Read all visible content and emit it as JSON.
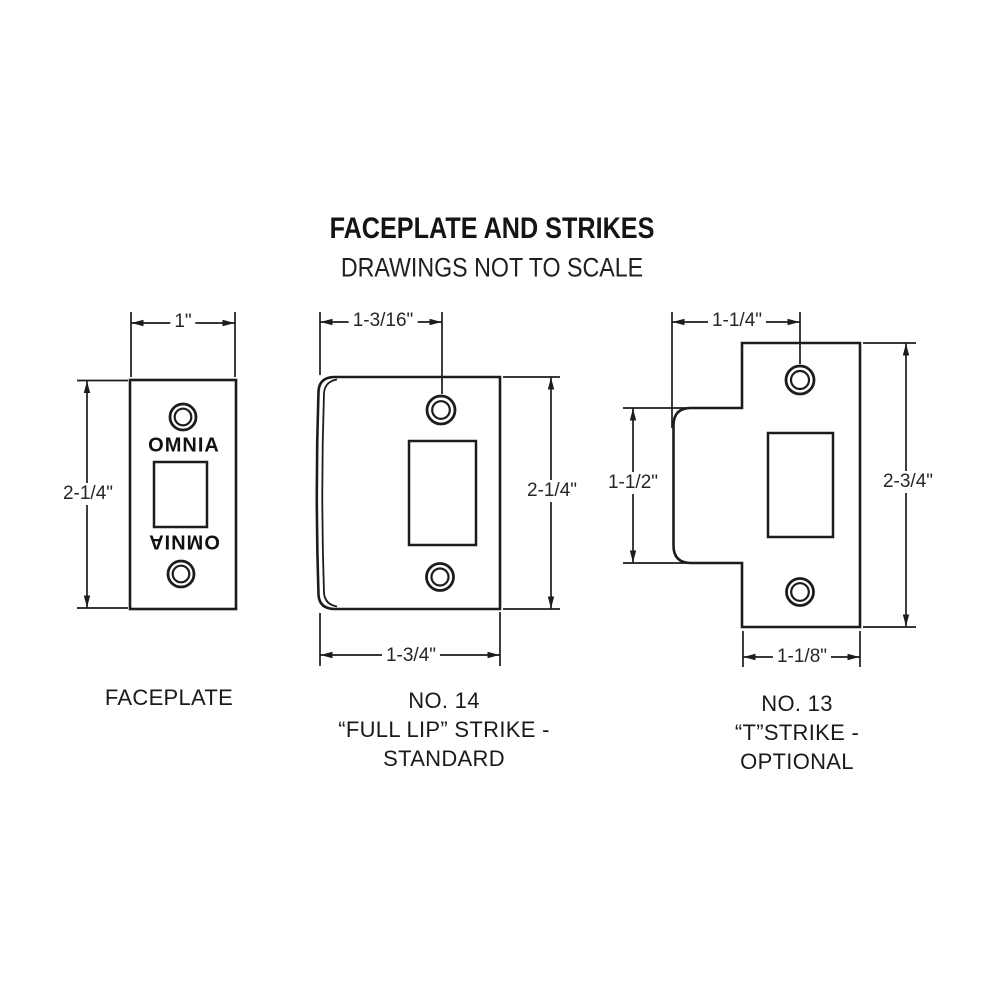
{
  "colors": {
    "ink": "#1c1c1c",
    "background": "#ffffff"
  },
  "header": {
    "title": "FACEPLATE AND STRIKES",
    "subtitle": "DRAWINGS NOT TO SCALE"
  },
  "figures": {
    "faceplate": {
      "label": "FACEPLATE",
      "engraving_top": "OMNIA",
      "engraving_bottom": "OMNIA",
      "dims": {
        "width": "1\"",
        "height": "2-1/4\""
      }
    },
    "full_lip_strike": {
      "label_no": "NO. 14",
      "label_type": "“FULL LIP” STRIKE -",
      "label_variant": "STANDARD",
      "dims": {
        "hole_offset": "1-3/16\"",
        "height": "2-1/4\"",
        "width": "1-3/4\""
      }
    },
    "t_strike": {
      "label_no": "NO. 13",
      "label_type": "“T”STRIKE -",
      "label_variant": "OPTIONAL",
      "dims": {
        "hole_offset": "1-1/4\"",
        "lip_height": "1-1/2\"",
        "height": "2-3/4\"",
        "width": "1-1/8\""
      }
    }
  }
}
